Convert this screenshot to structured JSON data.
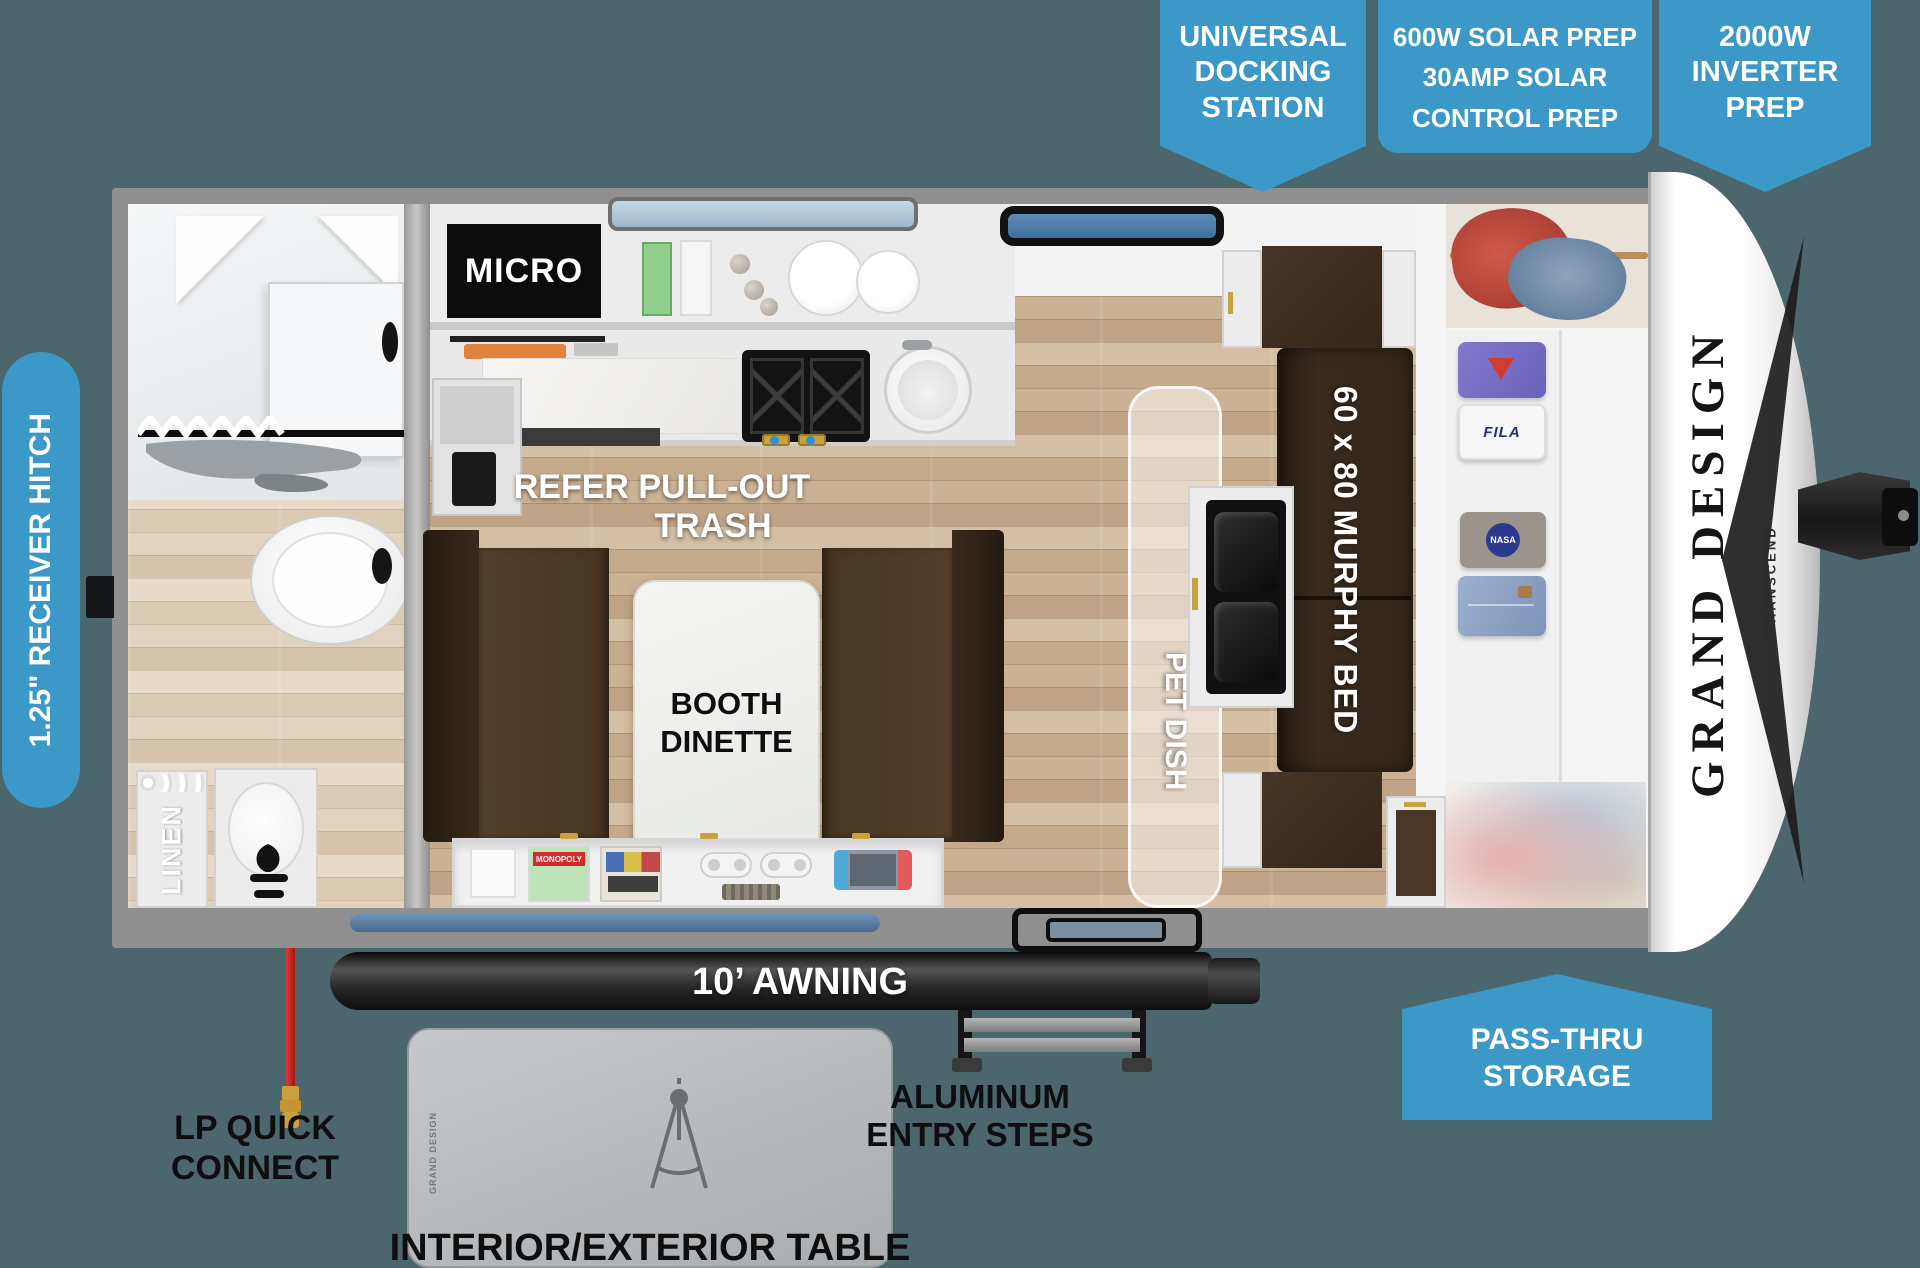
{
  "badges": {
    "universal_docking": {
      "line1": "UNIVERSAL",
      "line2": "DOCKING",
      "line3": "STATION"
    },
    "solar_prep": {
      "line1": "600W SOLAR PREP",
      "line2": "30AMP SOLAR",
      "line3": "CONTROL PREP"
    },
    "inverter_prep": {
      "line1": "2000W",
      "line2": "INVERTER",
      "line3": "PREP"
    },
    "pass_thru": {
      "line1": "PASS-THRU",
      "line2": "STORAGE"
    },
    "receiver_hitch": "1.25\" RECEIVER HITCH"
  },
  "labels": {
    "micro": "MICRO",
    "refer1": "REFER PULL-OUT",
    "refer2": "TRASH",
    "booth1": "BOOTH",
    "booth2": "DINETTE",
    "linen": "LINEN",
    "pet_dish": "PET DISH",
    "murphy": "60 x 80 MURPHY BED",
    "awning": "10’ AWNING",
    "lp1": "LP QUICK",
    "lp2": "CONNECT",
    "steps1": "ALUMINUM",
    "steps2": "ENTRY STEPS",
    "table": "INTERIOR/EXTERIOR TABLE"
  },
  "brand": {
    "name": "GRAND DESIGN",
    "model": "TRANSCEND",
    "table_logo": "GRAND DESIGN"
  },
  "items": {
    "monopoly": "MONOPOLY",
    "fila": "FILA",
    "nasa": "NASA"
  },
  "colors": {
    "badge_blue": "#3c98c7",
    "background": "#4c666d",
    "accent_red": "#cf2128"
  }
}
